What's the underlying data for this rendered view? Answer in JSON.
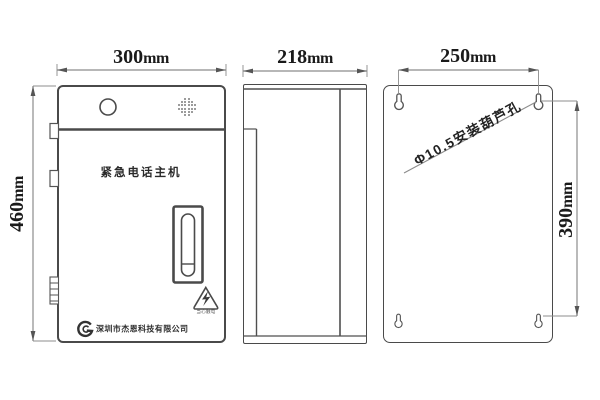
{
  "drawing": {
    "front": {
      "title": "紧急电话主机",
      "company": "深圳市杰恩科技有限公司",
      "warning_caption": "当心触电",
      "width": {
        "value": "300",
        "unit": "mm"
      },
      "height": {
        "value": "460",
        "unit": "mm"
      }
    },
    "side": {
      "width": {
        "value": "218",
        "unit": "mm"
      }
    },
    "back": {
      "width": {
        "value": "250",
        "unit": "mm"
      },
      "height": {
        "value": "390",
        "unit": "mm"
      },
      "hole_label": "Φ10.5安装葫芦孔"
    },
    "colors": {
      "outline": "#4a4a4a",
      "dimension_line": "#8c8c8c",
      "text": "#1a1a1a"
    }
  }
}
